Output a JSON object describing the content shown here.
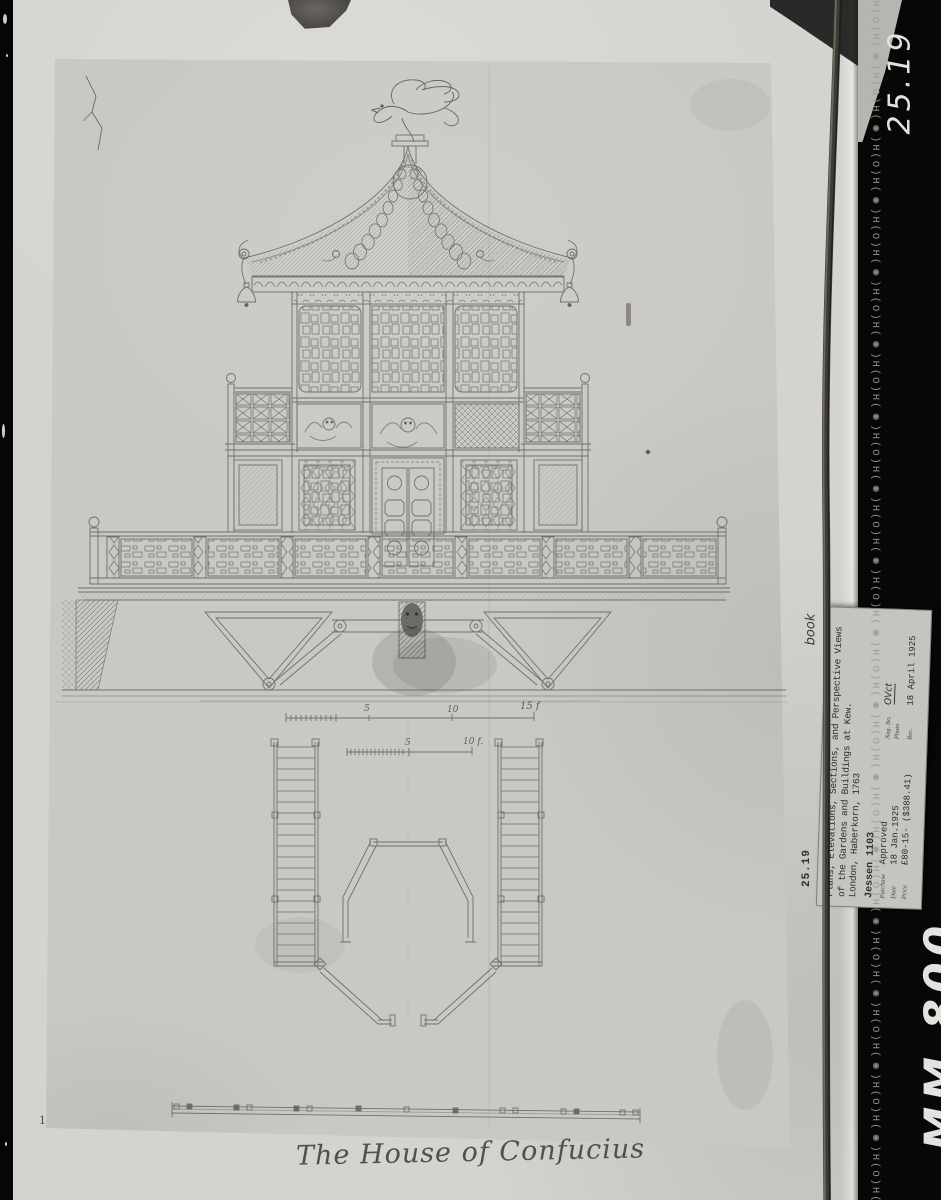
{
  "colors": {
    "film_black": "#070707",
    "album_page": "#d5d3cf",
    "sheet": "#cac8c3",
    "ink": "#6f6f6b",
    "label_bg": "#c6c4bf"
  },
  "film": {
    "edge_print_unit": "H(O)H(◉)",
    "mark_top": "25.19",
    "mark_bottom": "MM 800"
  },
  "album": {
    "note_book": "book",
    "accession": "25.19",
    "corner_mark": "1"
  },
  "label_card": {
    "title_line1": "Plans, Elevations, Sections, and Perspective Views",
    "title_line2": "of the Gardens and Buildings at Kew.",
    "title_line3": "London, Haberkorn, 1763",
    "reference": "Jessen 1103",
    "fields": [
      {
        "label": "Purchase",
        "value": "Approved"
      },
      {
        "label": "Date",
        "value": "18 Jan.1925"
      },
      {
        "label": "Price",
        "value": "£80-15- ($388.41)"
      },
      {
        "label": "Neg. No.",
        "value": "OVct"
      },
      {
        "label": "Photo",
        "value": ""
      },
      {
        "label": "Rec.",
        "value": "18 April 1925"
      }
    ]
  },
  "drawing": {
    "caption": "The House of Confucius",
    "scale_upper": [
      "5",
      "10",
      "15 f"
    ],
    "scale_lower": [
      "5",
      "10 f."
    ]
  }
}
